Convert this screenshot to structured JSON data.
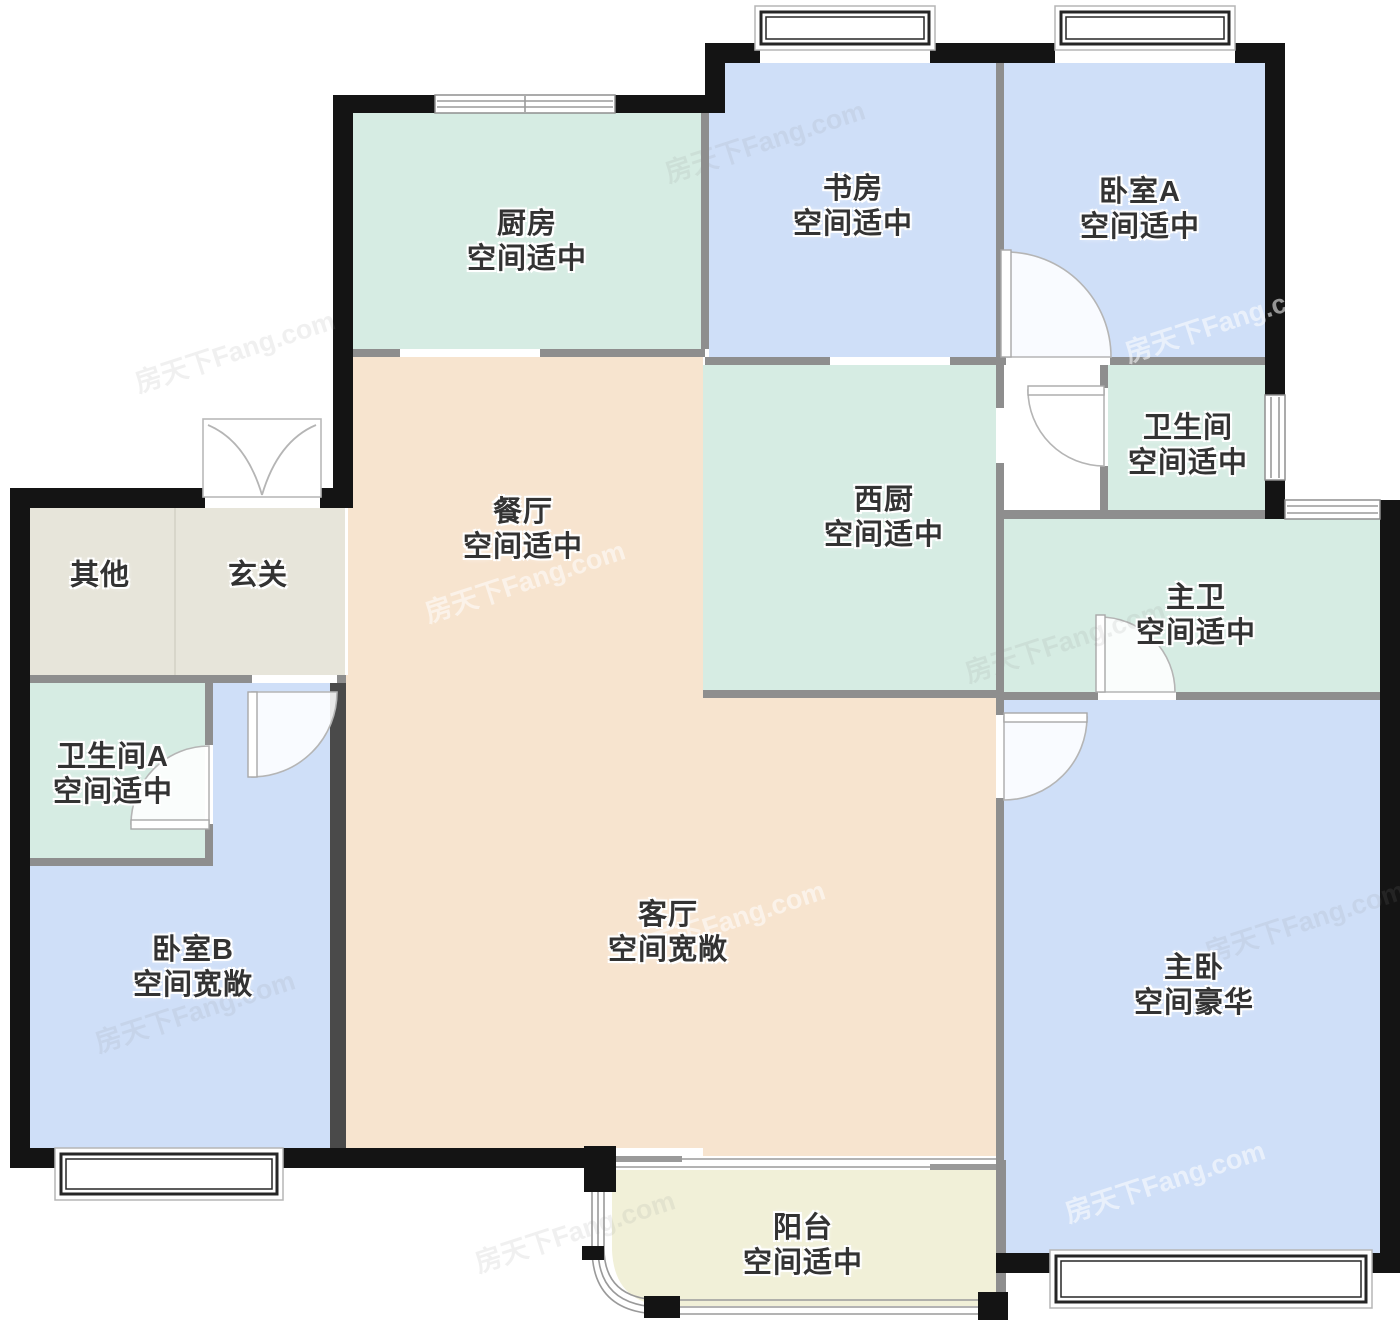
{
  "meta": {
    "type": "floor-plan",
    "watermark": "房天下Fang.com"
  },
  "palette": {
    "exterior_wall": "#141414",
    "partition_wall": "#8e8e8e",
    "room_blue": "#cfdff8",
    "room_green": "#d6ece3",
    "room_peach": "#f7e4cf",
    "room_cream": "#f1f0d8",
    "room_beige": "#e7e5da",
    "label_text": "#333333"
  },
  "rooms": [
    {
      "id": "kitchen",
      "name": "厨房",
      "note": "空间适中"
    },
    {
      "id": "study",
      "name": "书房",
      "note": "空间适中"
    },
    {
      "id": "bedroom-a",
      "name": "卧室A",
      "note": "空间适中"
    },
    {
      "id": "bathroom",
      "name": "卫生间",
      "note": "空间适中"
    },
    {
      "id": "dining-room",
      "name": "餐厅",
      "note": "空间适中"
    },
    {
      "id": "west-kitchen",
      "name": "西厨",
      "note": "空间适中"
    },
    {
      "id": "master-bath",
      "name": "主卫",
      "note": "空间适中"
    },
    {
      "id": "other",
      "name": "其他",
      "note": ""
    },
    {
      "id": "foyer",
      "name": "玄关",
      "note": ""
    },
    {
      "id": "bathroom-a",
      "name": "卫生间A",
      "note": "空间适中"
    },
    {
      "id": "bedroom-b",
      "name": "卧室B",
      "note": "空间宽敞"
    },
    {
      "id": "living-room",
      "name": "客厅",
      "note": "空间宽敞"
    },
    {
      "id": "master-bedroom",
      "name": "主卧",
      "note": "空间豪华"
    },
    {
      "id": "balcony",
      "name": "阳台",
      "note": "空间适中"
    }
  ]
}
